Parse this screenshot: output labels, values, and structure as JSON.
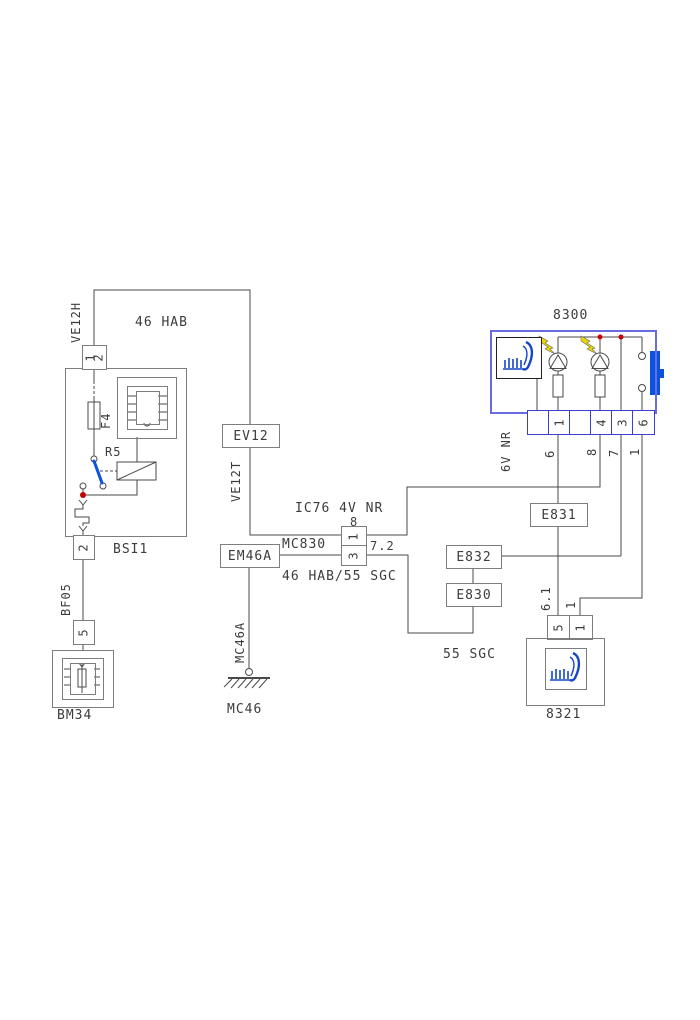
{
  "colors": {
    "wire": "#4a4a4a",
    "box": "#7d7d7d",
    "ink": "#3c3c3c",
    "blue": "#0a52e0",
    "seat_blue": "#1446c8",
    "module_blue": "#6b6be0",
    "connector_blue": "#3d3dd2",
    "red": "#c40000",
    "yellow": "#ecd500"
  },
  "labels": {
    "harness_top": "46 HAB",
    "ic76": "IC76 4V NR",
    "harness_mid": "46 HAB/55 SGC",
    "seat_fn": "55 SGC"
  },
  "bsi": {
    "name": "BSI1",
    "pin12": "12",
    "pin2": "2",
    "fuse": "F4",
    "relay": "R5"
  },
  "wires": {
    "ve12h": "VE12H",
    "ve12t": "VE12T",
    "bf05": "BF05",
    "mc46a": "MC46A",
    "w8h": "8",
    "w72": "7.2",
    "w6": "6",
    "w8v": "8",
    "w7": "7",
    "w1": "1",
    "w61": "6.1",
    "w1b": "1",
    "conn6v": "6V NR"
  },
  "boxes": {
    "ev12": "EV12",
    "em46a": "EM46A",
    "e831": "E831",
    "e832": "E832",
    "e830": "E830",
    "mc830": "MC830"
  },
  "mc830": {
    "pin1": "1",
    "pin3": "3"
  },
  "m8300": {
    "name": "8300",
    "pins": [
      "",
      "1",
      "",
      "4",
      "3",
      "6"
    ]
  },
  "m8321": {
    "name": "8321",
    "pin5": "5",
    "pin1": "1"
  },
  "bm34": {
    "name": "BM34",
    "pin5": "5"
  },
  "ground": {
    "name": "MC46"
  }
}
